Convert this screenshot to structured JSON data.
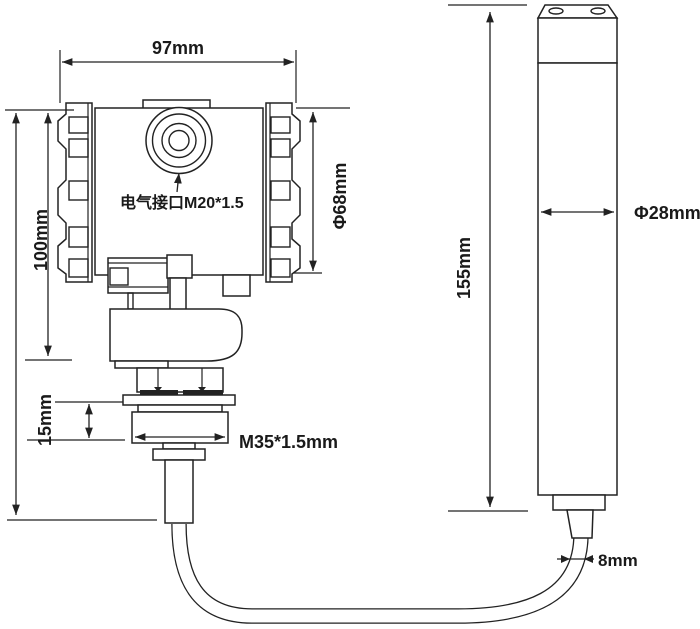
{
  "labels": {
    "housing_width": "97mm",
    "housing_height": "100mm",
    "housing_diameter": "Φ68mm",
    "electrical_port": "电气接口M20*1.5",
    "thread_length": "15mm",
    "thread_spec": "M35*1.5mm",
    "probe_length": "155mm",
    "probe_diameter": "Φ28mm",
    "cable_diameter": "8mm"
  },
  "colors": {
    "line": "#222222",
    "text": "#1a1a1a",
    "background": "#ffffff"
  }
}
